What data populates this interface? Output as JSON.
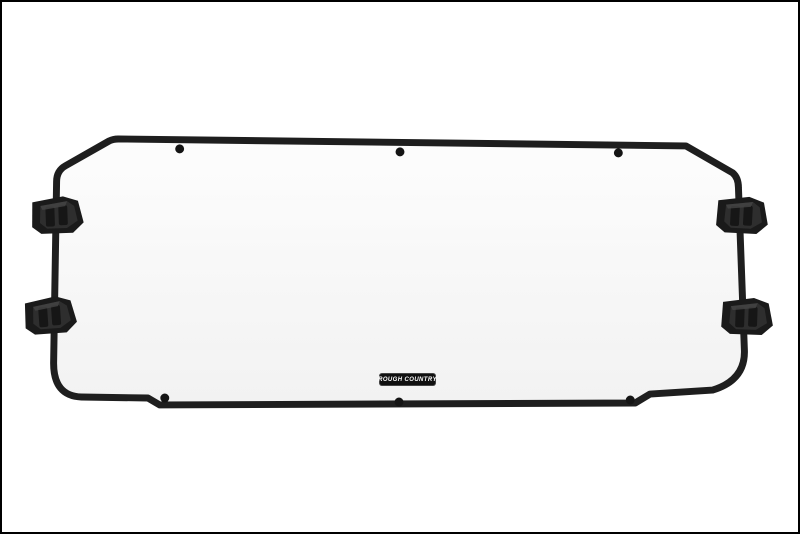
{
  "image": {
    "alt": "UTV windshield panel with black tube frame, six frame bolts and four black mounting clamps on a white background",
    "background_color": "#ffffff",
    "border_color": "#000000"
  },
  "badge": {
    "label": "ROUGH COUNTRY",
    "bg_color": "#101010",
    "text_color": "#ffffff"
  },
  "colors": {
    "frame": "#1e1e1e",
    "bolt": "#141414",
    "clamp_body": "#1a1a1a",
    "panel_top": "#fdfdfd",
    "panel_bottom": "#f2f2f2"
  }
}
